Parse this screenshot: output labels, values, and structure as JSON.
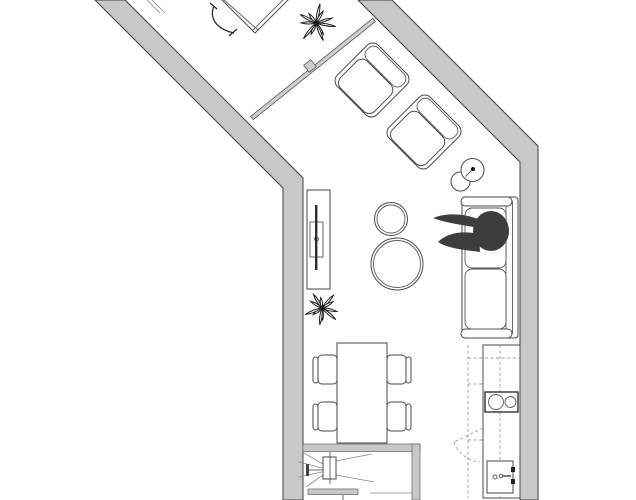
{
  "meta": {
    "title": "Apartment floor plan",
    "view": "top-down architectural drawing, black line work on white with gray walls",
    "visible_text": "none"
  },
  "palette": {
    "background": "#ffffff",
    "wall_fill": "#c8c8c8",
    "wall_stroke": "#3f3f3f",
    "partition_fill": "#cfcfcf",
    "furniture_stroke": "#4a4a4a",
    "detail_stroke": "#8a8a8a",
    "appliance_stroke": "#1a1a1a",
    "person_fill": "#3d3d3d",
    "plant_stroke": "#1c1c1c"
  },
  "legend": {
    "upper_wing_items": [
      "desk (cut off at top edge)",
      "desk-chair arc",
      "wardrobe edge lines",
      "potted-plant",
      "glass-partition with center post"
    ],
    "living_area_items": [
      "lounge-chair",
      "lounge-chair",
      "floor-lamp (two circles)",
      "sofa with two cushions",
      "person sitting on sofa",
      "small round coffee-table",
      "large round coffee-table",
      "tv-console with tv",
      "potted-plant"
    ],
    "dining_items": [
      "rectangular dining-table",
      "dining-chair",
      "dining-chair",
      "dining-chair",
      "dining-chair"
    ],
    "kitchen_items": [
      "counter run",
      "upper-cabinet dashed line",
      "cooktop with 2 burners",
      "sink with faucet",
      "dashed door-swing"
    ],
    "lower_room_items": [
      "wall-mounted fixture with spray/projection lines",
      "wall bar",
      "gray partition block"
    ]
  }
}
